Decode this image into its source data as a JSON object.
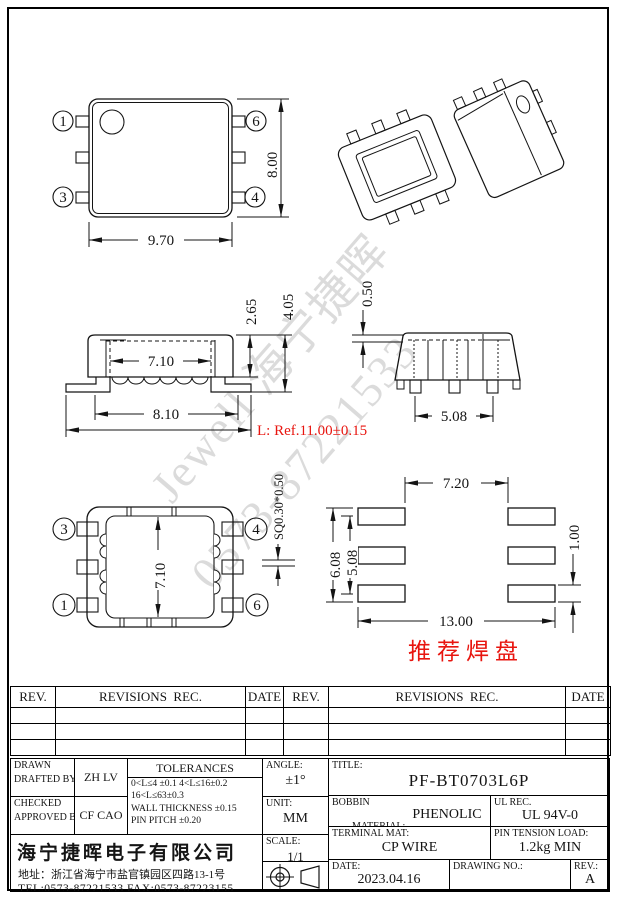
{
  "colors": {
    "line": "#141414",
    "accent_red": "#e8150f",
    "watermark_gray": "#c6c6c6"
  },
  "watermark": {
    "line1": "Jewell 海宁捷晖",
    "line2": "0573-87221533"
  },
  "views": {
    "top": {
      "balloon_tl": "1",
      "balloon_bl": "3",
      "balloon_tr": "6",
      "balloon_br": "4",
      "dim_width": "9.70",
      "dim_height": "8.00"
    },
    "front": {
      "dim_inner_width": "7.10",
      "dim_base_width": "8.10",
      "dim_length_ref": "L: Ref.11.00±0.15",
      "dim_upper_height": "2.65",
      "dim_total_height": "4.05"
    },
    "side": {
      "dim_standoff": "0.50",
      "dim_pin_span": "5.08"
    },
    "bottom": {
      "balloon_tl": "3",
      "balloon_tr": "4",
      "balloon_bl": "1",
      "balloon_br": "6",
      "dim_inner_height": "7.10",
      "dim_pin_section": "SQ0.30*0.50"
    },
    "pads": {
      "dim_inner_gap": "7.20",
      "dim_outer_rows": "6.08",
      "dim_row_pitch": "5.08",
      "dim_pad_height": "1.00",
      "dim_total_width": "13.00",
      "caption": "推荐焊盘"
    }
  },
  "revision_table": {
    "rev": "REV.",
    "revisions": "REVISIONS  REC.",
    "date": "DATE"
  },
  "title_block": {
    "drawn_line1": "DRAWN",
    "drawn_line2": "DRAFTED BY",
    "drawn_value": "ZH LV",
    "checked_line1": "CHECKED",
    "checked_line2": "APPROVED BY",
    "checked_value": "CF CAO",
    "tolerances_title": "TOLERANCES",
    "tolerances_line1": "0<L≤4 ±0.1 4<L≤16±0.2",
    "tolerances_line2": "16<L≤63±0.3",
    "tolerances_line3": "WALL THICKNESS ±0.15",
    "tolerances_line4": "PIN PITCH ±0.20",
    "angle_label": "ANGLE:",
    "angle_value": "±1°",
    "unit_label": "UNIT:",
    "unit_value": "MM",
    "scale_label": "SCALE:",
    "scale_value": "1/1",
    "title_label": "TITLE:",
    "title_value": "PF-BT0703L6P",
    "bobbin_label1": "BOBBIN",
    "bobbin_label2": "MATERIAL:",
    "bobbin_value": "PHENOLIC",
    "ul_label": "UL REC.",
    "ul_value": "UL 94V-0",
    "terminal_label": "TERMINAL MAT:",
    "terminal_value": "CP WIRE",
    "pin_tension_label": "PIN TENSION LOAD:",
    "pin_tension_value": "1.2kg MIN",
    "date_label": "DATE:",
    "date_value": "2023.04.16",
    "drawing_no_label": "DRAWING NO.:",
    "drawing_no_value": "",
    "rev_label": "REV.:",
    "rev_value": "A",
    "company_name": "海宁捷晖电子有限公司",
    "company_address": "地址：浙江省海宁市盐官镇园区四路13-1号",
    "company_tel": "TEL:0573-87221533 FAX:0573-87223155"
  }
}
